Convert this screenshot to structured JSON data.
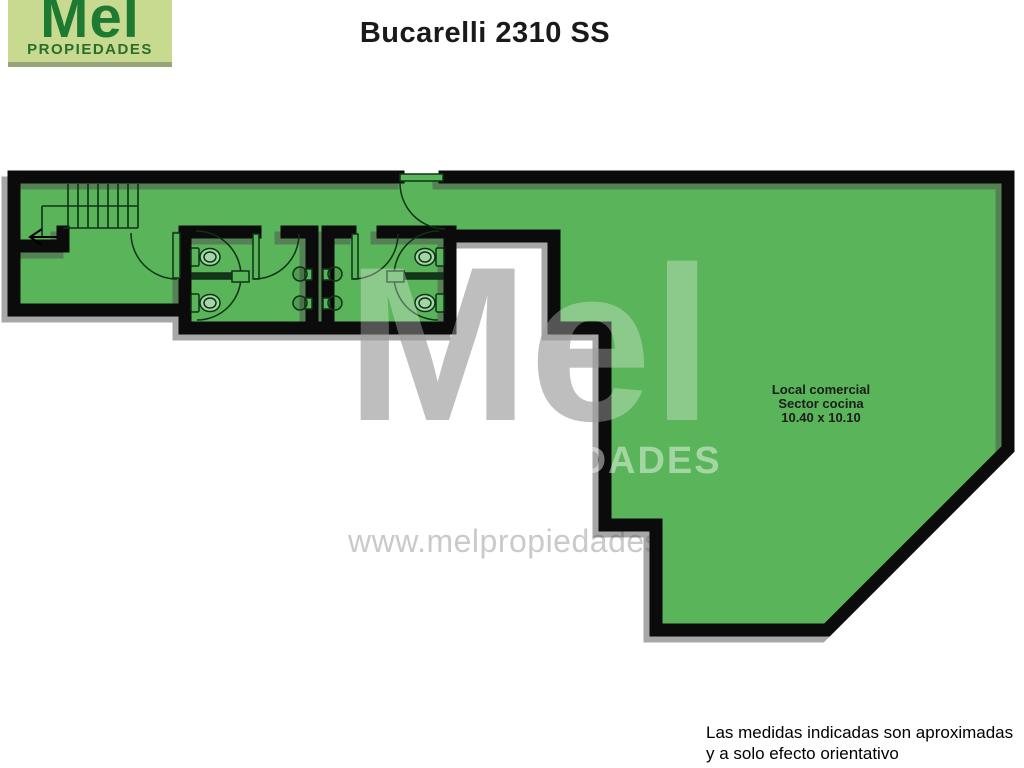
{
  "logo": {
    "name": "Mel",
    "tagline": "PROPIEDADES"
  },
  "title": "Bucarelli 2310 SS",
  "plan": {
    "room_label": {
      "line1": "Local comercial",
      "line2": "Sector cocina",
      "line3": "10.40 x 10.10"
    }
  },
  "watermark": {
    "big": "Mel",
    "word": "PROPIEDADES",
    "url": "www.melpropiedades.com"
  },
  "disclaimer": {
    "line1": "Las medidas indicadas son aproximadas",
    "line2": "y a solo efecto orientativo"
  },
  "colors": {
    "plan_green": "#5ab45a",
    "wall": "#0b0b0b",
    "wall_shadow": "#4f4f4f",
    "fixture_line": "#0e3317",
    "logo_bg": "#c7da8f",
    "logo_text": "#1e7a33"
  }
}
